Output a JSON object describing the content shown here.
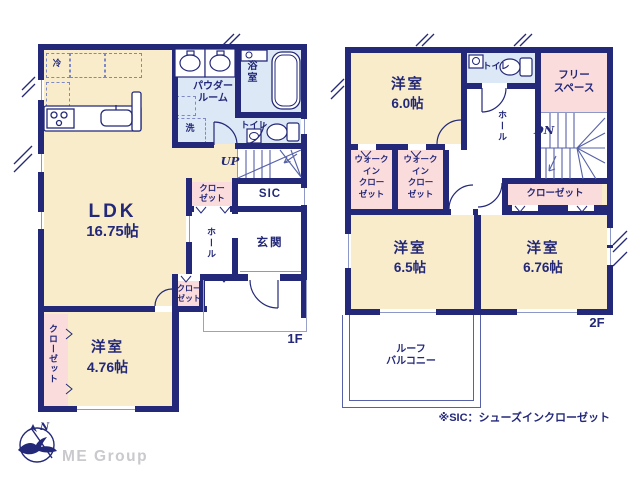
{
  "colors": {
    "wall": "#232878",
    "room_cream": "#f8ecca",
    "closet_pink": "#fbdcdc",
    "wet_blue": "#dce8f5",
    "thin_line": "#8d97c8",
    "brand_gray": "#c9c9ce"
  },
  "compass": {
    "label": "N"
  },
  "brand": {
    "name": "ME Group"
  },
  "note": {
    "text": "※SIC：シューズインクローゼット"
  },
  "f1": {
    "label": "1F",
    "ldk_name": "LDK",
    "ldk_size": "16.75帖",
    "room_name": "洋室",
    "room_size": "4.76帖",
    "powder": "パウダー\nルーム",
    "bath": "浴室",
    "wash": "洗",
    "fridge": "冷",
    "toilet": "トイレ",
    "up": "UP",
    "closet_a": "クロー\nゼット",
    "sic": "SIC",
    "hall": "ホール",
    "genkan": "玄関",
    "closet_b": "クロー\nゼット",
    "closet_c": "クローゼット"
  },
  "f2": {
    "label": "2F",
    "room1_name": "洋室",
    "room1_size": "6.0帖",
    "room2_name": "洋室",
    "room2_size": "6.5帖",
    "room3_name": "洋室",
    "room3_size": "6.76帖",
    "toilet": "トイレ",
    "free_space": "フリー\nスペース",
    "dn": "DN",
    "hall": "ホール",
    "wic_a": "ウォーク\nイン\nクロー\nゼット",
    "wic_b": "ウォーク\nイン\nクロー\nゼット",
    "closet": "クローゼット",
    "balcony": "ルーフ\nバルコニー"
  }
}
